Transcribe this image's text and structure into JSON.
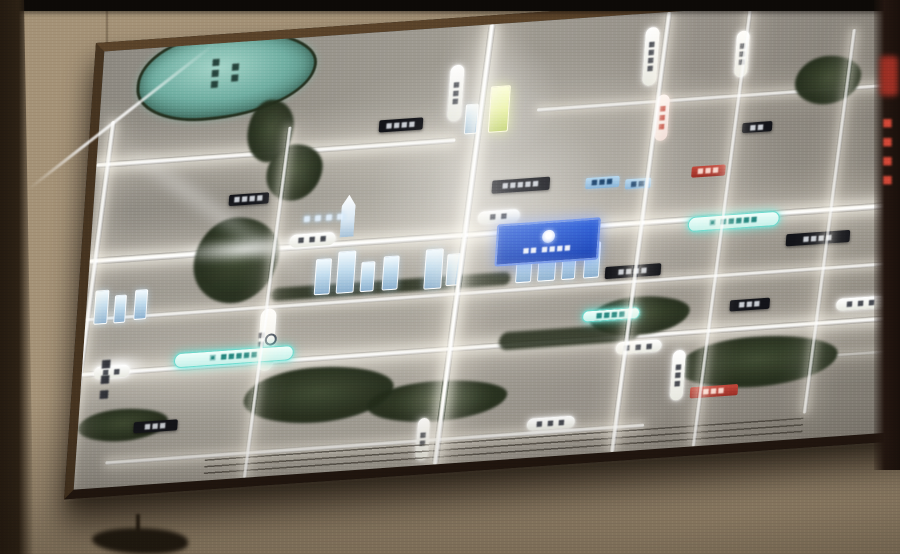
{
  "scene": {
    "description_colors": {
      "wall_beige": "#b4a286",
      "frame_brown": "#46321e",
      "map_base_gray": "#97928a",
      "road_glow_white": "#fffaf0",
      "water_teal": "#6fb0a3",
      "park_dark_green": "#28321d",
      "metro_teal": "#58e0d3",
      "project_blue": "#1f4fc9",
      "accent_red": "#b23428"
    }
  },
  "panel": {
    "kind": "backlit-site-map-board",
    "scale_bar_present": true
  },
  "labels": {
    "right_column_red_text": "■■■■",
    "district_vertical_text": "■■■"
  },
  "map": {
    "size": {
      "w": 1000,
      "h": 435
    },
    "elements": [
      {
        "k": "road-h",
        "n": "road-horizontal",
        "x": 440,
        "y": 86,
        "w": 560,
        "h": 5,
        "o": 0.8
      },
      {
        "k": "road-h road-big",
        "n": "road-horizontal",
        "x": 0,
        "y": 110,
        "w": 360,
        "h": 6,
        "o": 0.95
      },
      {
        "k": "road-h road-big",
        "n": "road-horizontal-main",
        "x": 0,
        "y": 205,
        "w": 1000,
        "h": 7,
        "o": 1
      },
      {
        "k": "road-h",
        "n": "road-horizontal",
        "x": 0,
        "y": 264,
        "w": 1000,
        "h": 5,
        "o": 0.85
      },
      {
        "k": "road-h road-big",
        "n": "road-horizontal",
        "x": 0,
        "y": 318,
        "w": 1000,
        "h": 6,
        "o": 0.95
      },
      {
        "k": "road-h",
        "n": "road-horizontal",
        "x": 600,
        "y": 352,
        "w": 400,
        "h": 4,
        "o": 0.45
      },
      {
        "k": "road-h",
        "n": "road-horizontal",
        "x": 30,
        "y": 408,
        "w": 540,
        "h": 5,
        "o": 0.8
      },
      {
        "k": "road-v",
        "n": "road-vertical",
        "x": 2,
        "y": 70,
        "w": 6,
        "h": 365,
        "o": 0.9,
        "layer": "v"
      },
      {
        "k": "road-v",
        "n": "road-vertical",
        "x": 182,
        "y": 88,
        "w": 5,
        "h": 347,
        "o": 0.85,
        "layer": "v"
      },
      {
        "k": "road-v road-big",
        "n": "road-vertical-main",
        "x": 372,
        "y": 0,
        "w": 7,
        "h": 435,
        "o": 1,
        "layer": "v"
      },
      {
        "k": "road-v",
        "n": "road-vertical",
        "x": 550,
        "y": 0,
        "w": 6,
        "h": 435,
        "o": 0.9,
        "layer": "v"
      },
      {
        "k": "road-v",
        "n": "road-vertical",
        "x": 632,
        "y": 0,
        "w": 5,
        "h": 435,
        "o": 0.8,
        "layer": "v"
      },
      {
        "k": "road-v",
        "n": "road-vertical",
        "x": 740,
        "y": 30,
        "w": 5,
        "h": 380,
        "o": 0.75,
        "layer": "v"
      },
      {
        "k": "road-v",
        "n": "road-vertical",
        "x": 905,
        "y": 0,
        "w": 4,
        "h": 300,
        "o": 0.5,
        "layer": "v"
      },
      {
        "k": "lake",
        "n": "lake-shape",
        "x": 35,
        "y": -12,
        "w": 180,
        "h": 88
      },
      {
        "k": "park",
        "n": "river-shape",
        "x": 150,
        "y": 60,
        "w": 46,
        "h": 62
      },
      {
        "k": "park",
        "n": "river-shape",
        "x": 172,
        "y": 106,
        "w": 56,
        "h": 56
      },
      {
        "k": "park",
        "n": "trees-shape",
        "x": 105,
        "y": 175,
        "w": 85,
        "h": 85
      },
      {
        "k": "band",
        "n": "green-corridor",
        "x": 185,
        "y": 248,
        "w": 240,
        "h": 13
      },
      {
        "k": "park",
        "n": "park-shape",
        "x": 165,
        "y": 330,
        "w": 150,
        "h": 55
      },
      {
        "k": "park",
        "n": "park-shape",
        "x": 290,
        "y": 352,
        "w": 140,
        "h": 40
      },
      {
        "k": "band",
        "n": "green-corridor",
        "x": 418,
        "y": 308,
        "w": 140,
        "h": 18
      },
      {
        "k": "park",
        "n": "park-shape",
        "x": 508,
        "y": 282,
        "w": 100,
        "h": 38
      },
      {
        "k": "park",
        "n": "park-shape",
        "x": 600,
        "y": 330,
        "w": 160,
        "h": 50
      },
      {
        "k": "park",
        "n": "trees-shape",
        "x": 698,
        "y": 55,
        "w": 66,
        "h": 48
      },
      {
        "k": "park",
        "n": "park-shape",
        "x": 0,
        "y": 358,
        "w": 90,
        "h": 32
      },
      {
        "k": "glow-blob",
        "n": "light-glow",
        "x": 55,
        "y": 190,
        "w": 200,
        "h": 34
      },
      {
        "k": "glow-blob",
        "n": "light-glow",
        "x": -10,
        "y": 298,
        "w": 90,
        "h": 36
      },
      {
        "k": "bldg",
        "n": "building-icon",
        "x": 228,
        "y": 222,
        "w": 16,
        "h": 36
      },
      {
        "k": "bldg",
        "n": "building-icon",
        "x": 250,
        "y": 216,
        "w": 18,
        "h": 42
      },
      {
        "k": "bldg",
        "n": "building-icon",
        "x": 274,
        "y": 228,
        "w": 14,
        "h": 30
      },
      {
        "k": "bldg",
        "n": "building-icon",
        "x": 296,
        "y": 224,
        "w": 16,
        "h": 34
      },
      {
        "k": "bldg",
        "n": "building-icon",
        "x": 338,
        "y": 220,
        "w": 18,
        "h": 40
      },
      {
        "k": "bldg",
        "n": "building-icon",
        "x": 360,
        "y": 226,
        "w": 14,
        "h": 32
      },
      {
        "k": "bldg",
        "n": "building-icon",
        "x": 430,
        "y": 222,
        "w": 16,
        "h": 38
      },
      {
        "k": "bldg",
        "n": "building-icon",
        "x": 452,
        "y": 216,
        "w": 18,
        "h": 44
      },
      {
        "k": "bldg",
        "n": "building-icon",
        "x": 476,
        "y": 226,
        "w": 14,
        "h": 34
      },
      {
        "k": "bldg",
        "n": "building-icon",
        "x": 498,
        "y": 224,
        "w": 16,
        "h": 36
      },
      {
        "k": "bldg",
        "n": "building-icon",
        "x": 8,
        "y": 238,
        "w": 14,
        "h": 34
      },
      {
        "k": "bldg",
        "n": "building-icon",
        "x": 28,
        "y": 244,
        "w": 12,
        "h": 28
      },
      {
        "k": "bldg",
        "n": "building-icon",
        "x": 48,
        "y": 240,
        "w": 13,
        "h": 30
      },
      {
        "k": "bldg-yellow",
        "n": "landmark-building-icon",
        "x": 392,
        "y": 62,
        "w": 20,
        "h": 46
      },
      {
        "k": "bldg",
        "n": "building-icon",
        "x": 368,
        "y": 78,
        "w": 13,
        "h": 30
      },
      {
        "k": "bldg-spire",
        "n": "tower-building-icon",
        "x": 250,
        "y": 160,
        "w": 14,
        "h": 42
      },
      {
        "k": "pill-h",
        "n": "road-name-pill",
        "x": 200,
        "y": 196,
        "w": 46,
        "h": 13,
        "g": "■ ■ ■"
      },
      {
        "k": "text-glow",
        "n": "street-name-glow",
        "x": 196,
        "y": 176,
        "w": 74,
        "h": 11,
        "g": "■ ■ ■ ■"
      },
      {
        "k": "pill-h",
        "n": "road-name-pill",
        "x": 388,
        "y": 186,
        "w": 42,
        "h": 12,
        "g": "■ ■"
      },
      {
        "k": "pill-h",
        "n": "road-name-pill",
        "x": 12,
        "y": 314,
        "w": 36,
        "h": 12,
        "g": "■ ■"
      },
      {
        "k": "pill-h",
        "n": "road-name-pill",
        "x": 536,
        "y": 326,
        "w": 46,
        "h": 12,
        "g": "■ ■ ■"
      },
      {
        "k": "pill-h",
        "n": "road-name-pill",
        "x": 452,
        "y": 396,
        "w": 48,
        "h": 12,
        "g": "■ ■ ■"
      },
      {
        "k": "pill-h",
        "n": "road-name-pill",
        "x": 755,
        "y": 298,
        "w": 50,
        "h": 12,
        "g": "■ ■ ■"
      },
      {
        "k": "pill-v",
        "n": "road-name-pill-vertical",
        "x": 350,
        "y": 38,
        "w": 14,
        "h": 56,
        "g": "■■■"
      },
      {
        "k": "pill-v",
        "n": "road-name-pill-vertical",
        "x": 544,
        "y": 14,
        "w": 14,
        "h": 58,
        "g": "■■■■"
      },
      {
        "k": "pill-v",
        "n": "road-name-pill-vertical",
        "x": 636,
        "y": 24,
        "w": 13,
        "h": 46,
        "g": "■■■"
      },
      {
        "k": "pill-v",
        "n": "road-name-pill-vertical",
        "x": 806,
        "y": 268,
        "w": 13,
        "h": 44,
        "g": "■■■"
      },
      {
        "k": "pill-v",
        "n": "road-name-pill-vertical",
        "x": 594,
        "y": 338,
        "w": 13,
        "h": 50,
        "g": "■■■"
      },
      {
        "k": "pill-v",
        "n": "road-name-pill-vertical",
        "x": 342,
        "y": 388,
        "w": 12,
        "h": 42,
        "g": "■■"
      },
      {
        "k": "station-pill",
        "n": "metro-station-pill",
        "x": 176,
        "y": 268,
        "w": 16,
        "h": 62,
        "g": "■■"
      },
      {
        "k": "metro-pill",
        "n": "metro-line-pill",
        "x": 600,
        "y": 206,
        "w": 92,
        "h": 15,
        "g": "▣ ■■■■■"
      },
      {
        "k": "metro-pill",
        "n": "metro-line-pill",
        "x": 92,
        "y": 306,
        "w": 120,
        "h": 15,
        "g": "▣ ■■■■■"
      },
      {
        "k": "metro-pill",
        "n": "metro-poi-pill",
        "x": 500,
        "y": 292,
        "w": 58,
        "h": 12,
        "g": "■■■■"
      },
      {
        "k": "pill-red-v",
        "n": "red-line-pill-vertical",
        "x": 560,
        "y": 82,
        "w": 13,
        "h": 46,
        "g": "■■■"
      },
      {
        "k": "plaque-dark",
        "n": "poi-plaque",
        "x": 136,
        "y": 152,
        "w": 40,
        "h": 11,
        "g": "■■■■"
      },
      {
        "k": "plaque-dark",
        "n": "poi-plaque",
        "x": 400,
        "y": 156,
        "w": 58,
        "h": 13,
        "g": "■■■■■"
      },
      {
        "k": "plaque-dark",
        "n": "poi-plaque",
        "x": 282,
        "y": 88,
        "w": 44,
        "h": 12,
        "g": "■■■■"
      },
      {
        "k": "plaque-blue",
        "n": "poi-plaque-blue",
        "x": 494,
        "y": 160,
        "w": 34,
        "h": 11,
        "g": "■■■"
      },
      {
        "k": "plaque-blue",
        "n": "poi-plaque-blue",
        "x": 534,
        "y": 164,
        "w": 26,
        "h": 10,
        "g": "■■"
      },
      {
        "k": "plaque-red",
        "n": "poi-plaque-red",
        "x": 600,
        "y": 156,
        "w": 34,
        "h": 11,
        "g": "■■■"
      },
      {
        "k": "plaque-dark",
        "n": "poi-plaque",
        "x": 648,
        "y": 116,
        "w": 30,
        "h": 10,
        "g": "■■"
      },
      {
        "k": "plaque-dark",
        "n": "poi-plaque",
        "x": 520,
        "y": 250,
        "w": 56,
        "h": 12,
        "g": "■■■■"
      },
      {
        "k": "plaque-dark",
        "n": "poi-plaque",
        "x": 648,
        "y": 292,
        "w": 40,
        "h": 11,
        "g": "■■■"
      },
      {
        "k": "plaque-red",
        "n": "poi-plaque-red",
        "x": 614,
        "y": 376,
        "w": 48,
        "h": 11,
        "g": "■■■"
      },
      {
        "k": "plaque-dark",
        "n": "poi-plaque",
        "x": 56,
        "y": 372,
        "w": 44,
        "h": 11,
        "g": "■■■"
      },
      {
        "k": "plaque-dark",
        "n": "poi-plaque",
        "x": 700,
        "y": 230,
        "w": 64,
        "h": 12,
        "g": "■■■■"
      },
      {
        "k": "v-text-dark",
        "n": "district-name-vertical",
        "x": 14,
        "y": 294,
        "w": 18,
        "h": 66,
        "g": "■■■"
      },
      {
        "k": "lake-label",
        "n": "lake-name-vertical",
        "x": 106,
        "y": 2,
        "w": 14,
        "h": 56,
        "g": "■■■"
      },
      {
        "k": "lake-label",
        "n": "lake-name-vertical",
        "x": 126,
        "y": 6,
        "w": 14,
        "h": 50,
        "g": "■■"
      },
      {
        "k": "project-plaque",
        "n": "project-plaque",
        "x": 408,
        "y": 200,
        "w": 104,
        "h": 42,
        "g": "■■ ■■■■"
      },
      {
        "k": "scale-lines",
        "n": "scale-bar-lines",
        "x": 130,
        "y": 414,
        "w": 600,
        "h": 17
      }
    ]
  }
}
